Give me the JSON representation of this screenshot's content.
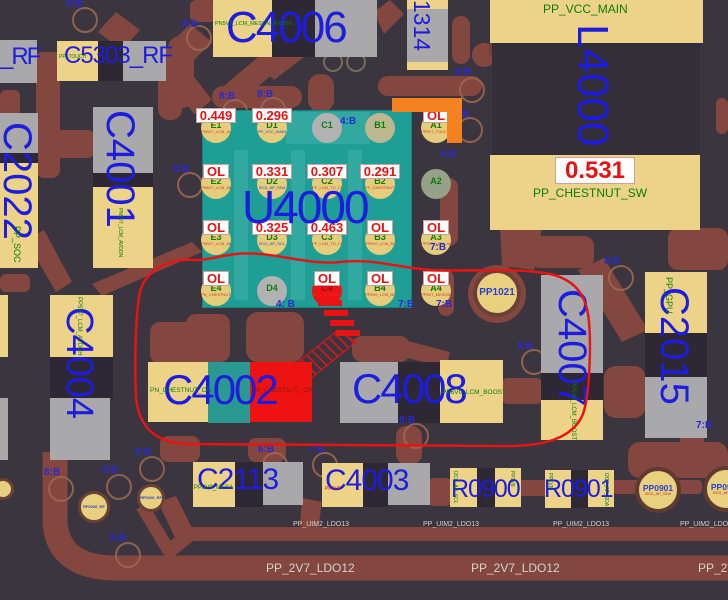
{
  "colors": {
    "board_bg": "#3b3540",
    "copper": "#83473f",
    "pad_yellow": "#ecd387",
    "pad_gray": "#a9a9ab",
    "chip_teal": "#1f9e96",
    "highlight_red": "#ee1212",
    "annotation_red": "#e81414",
    "label_blue": "#1d1de0",
    "net_green": "#0c7c0c",
    "via_blue": "#2a2ad0",
    "orange_marker": "#f5821e"
  },
  "components": {
    "rf_partial": {
      "ref": "_RF"
    },
    "c5303": {
      "ref": "C5303_RF",
      "net": "PP_TOUCH"
    },
    "c2022": {
      "ref": "C2022",
      "net": "PP_SOC"
    },
    "c4001": {
      "ref": "C4001",
      "net": "PN5V7_LCM_AVDDN"
    },
    "c4006": {
      "ref": "C4006",
      "net": "PN5V7_LCM_MESON_AVDDN"
    },
    "c1314": {
      "ref": "1314"
    },
    "l4000": {
      "ref": "L4000",
      "net_top": "PP_VCC_MAIN",
      "net_bottom": "PP_CHESTNUT_SW",
      "value": "0.531"
    },
    "u4000": {
      "ref": "U4000"
    },
    "c4002": {
      "ref": "C4002",
      "net_left": "PN_CHESTNUT_CN",
      "net_right": "PP_CHESTNUT_CP"
    },
    "c4008": {
      "ref": "C4008",
      "net": "PP6V0_LCM_BOOST"
    },
    "c4007": {
      "ref": "C4007",
      "net": "PP6V0_LCM_BOOST"
    },
    "c2015": {
      "ref": "C2015",
      "net": "PP_GPU"
    },
    "c4004": {
      "ref": "C4004",
      "net": "PP5V7_LCM_AVDDH"
    },
    "c2113": {
      "ref": "C2113",
      "net": "PP3V0_MESA"
    },
    "c4003": {
      "ref": "C4003",
      "net": "PP1V8"
    },
    "r0900": {
      "ref": "R0900",
      "net_left": "I2C0_AP_SCL",
      "net_right": "PP1V8"
    },
    "r0901": {
      "ref": "R0901",
      "net_left": "PP1V8",
      "net_right": "I2C0_AP_SDA"
    }
  },
  "testpoints": {
    "pp1021": {
      "ref": "PP1021"
    },
    "pp0901_a": {
      "ref": "PP0901",
      "net": "I2C0_AP_SDA"
    },
    "pp0901_b": {
      "ref": "PP0901",
      "net": "I2C0_AP_SDA"
    }
  },
  "tp_small": [
    {
      "text": "RF0026_RF",
      "x": 78,
      "y": 491,
      "d": 26
    },
    {
      "text": "RF0026_RF",
      "x": 137,
      "y": 484,
      "d": 22
    }
  ],
  "u4000_balls": [
    {
      "n": "E1",
      "t": "tan",
      "v": "0.449",
      "s": "PN5V7_LCM_AVDDN",
      "sc": "r"
    },
    {
      "n": "D1",
      "t": "tan",
      "v": "0.296",
      "s": "PP_VCC_MAIN",
      "sc": "b"
    },
    {
      "n": "C1",
      "t": "gray"
    },
    {
      "n": "B1",
      "t": "graytan"
    },
    {
      "n": "A1",
      "t": "tan",
      "v": "OL",
      "s": "PP5V7_TOUCH_VDDH",
      "sc": "r"
    },
    {
      "n": "E2",
      "t": "tan",
      "v": "OL",
      "s": "PN5V7_LCM_MESON_AVDDN",
      "sc": "r"
    },
    {
      "n": "D2",
      "t": "tan",
      "v": "0.331",
      "s": "I2C0_AP_SDA",
      "sc": "b"
    },
    {
      "n": "C2",
      "t": "tan",
      "v": "0.307",
      "s": "PP_LCM_TO_CHESTNUT",
      "sc": "r"
    },
    {
      "n": "B2",
      "t": "tan",
      "v": "0.291",
      "s": "PP_CHESTNUT_SW",
      "sc": "r"
    },
    {
      "n": "A2",
      "t": "olive"
    },
    {
      "n": "E3",
      "t": "tan",
      "v": "OL",
      "s": "PN5V7_LCM_MESON_AVDDN",
      "sc": "r"
    },
    {
      "n": "D3",
      "t": "tan",
      "v": "0.325",
      "s": "I2C0_AP_SCL",
      "sc": "b"
    },
    {
      "n": "C3",
      "t": "tan",
      "v": "0.463",
      "s": "PP_LCM_TO_CHESTNUT",
      "sc": "r"
    },
    {
      "n": "B3",
      "t": "tan",
      "v": "OL",
      "s": "PP6V0_LCM_BOOST",
      "sc": "r"
    },
    {
      "n": "A3",
      "t": "tan",
      "v": "OL",
      "s": "PP5V7_LCM_AVDDH",
      "sc": "r"
    },
    {
      "n": "E4",
      "t": "tan",
      "v": "OL",
      "s": "PN_CHESTNUT_CN",
      "sc": "r"
    },
    {
      "n": "D4",
      "t": "gray"
    },
    {
      "n": "C4",
      "t": "red",
      "v": "OL",
      "s": "PP_CHESTNUT_CP",
      "sc": "r",
      "nmc": "#8a1111"
    },
    {
      "n": "B4",
      "t": "tan",
      "v": "OL",
      "s": "PP6V0_LCM_BOOST",
      "sc": "r"
    },
    {
      "n": "A4",
      "t": "tan",
      "v": "OL",
      "s": "PP5V7_MESON_AVDDH",
      "sc": "r"
    }
  ],
  "vias": [
    {
      "label": "8:B",
      "x": 66,
      "y": 0,
      "ring": [
        83,
        18
      ]
    },
    {
      "label": "8:B",
      "x": 182,
      "y": 20,
      "ring": [
        197,
        36
      ]
    },
    {
      "label": "8:B",
      "x": 219,
      "y": 92,
      "ring": [
        233,
        110
      ]
    },
    {
      "label": "8:B",
      "x": 257,
      "y": 90,
      "ring": [
        271,
        108
      ]
    },
    {
      "label": "8:B",
      "x": 173,
      "y": 165,
      "ring": [
        188,
        183
      ]
    },
    {
      "label": "8:B",
      "x": 455,
      "y": 68,
      "ring": [
        470,
        88
      ]
    },
    {
      "label": "7:B",
      "x": 453,
      "y": 110,
      "ring": [
        468,
        128
      ]
    },
    {
      "label": "4:B",
      "x": 340,
      "y": 117
    },
    {
      "label": "4:B",
      "x": 440,
      "y": 150
    },
    {
      "label": "7:B",
      "x": 430,
      "y": 243
    },
    {
      "label": "4: B",
      "x": 276,
      "y": 300
    },
    {
      "label": "7:B",
      "x": 398,
      "y": 300
    },
    {
      "label": "7:B",
      "x": 436,
      "y": 300
    },
    {
      "label": "8:B",
      "x": 604,
      "y": 257,
      "ring": [
        619,
        276
      ]
    },
    {
      "label": "8:B",
      "x": 517,
      "y": 342,
      "ring": [
        532,
        360
      ]
    },
    {
      "label": "8:B",
      "x": 399,
      "y": 416,
      "ring": [
        414,
        434
      ]
    },
    {
      "label": "6:B",
      "x": 258,
      "y": 445,
      "ring": [
        273,
        463
      ]
    },
    {
      "label": "7:B",
      "x": 308,
      "y": 445,
      "ring": [
        323,
        463
      ]
    },
    {
      "label": "8:B",
      "x": 135,
      "y": 448,
      "ring": [
        150,
        467
      ]
    },
    {
      "label": "8:B",
      "x": 44,
      "y": 468,
      "ring": [
        59,
        487
      ]
    },
    {
      "label": "8:B",
      "x": 102,
      "y": 466,
      "ring": [
        117,
        485
      ]
    },
    {
      "label": "8:B",
      "x": 110,
      "y": 534,
      "ring": [
        126,
        553
      ]
    },
    {
      "label": "7:B",
      "x": 696,
      "y": 421
    }
  ],
  "nets_traces": {
    "uim2": {
      "text": "PP_UIM2_LDO13",
      "y": 521,
      "xs": [
        293,
        423,
        553,
        680
      ]
    },
    "ldo12": {
      "text": "PP_2V7_LDO12",
      "y": 562,
      "xs": [
        266,
        471,
        698
      ]
    }
  }
}
